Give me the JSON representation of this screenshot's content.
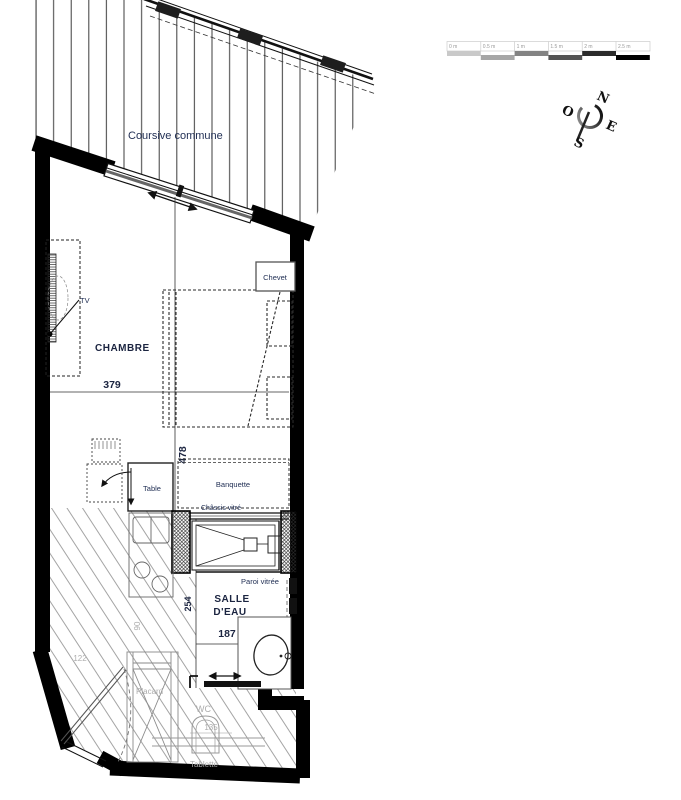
{
  "plan": {
    "walkway_label": "Coursive commune",
    "rooms": {
      "chambre": {
        "name": "CHAMBRE",
        "width_cm": "379",
        "depth_cm": "478"
      },
      "salle_deau": {
        "name_line1": "SALLE",
        "name_line2": "D'EAU",
        "width_cm": "187",
        "depth_cm": "254"
      },
      "wc": {
        "name": "WC",
        "width_cm": "135"
      },
      "entry": {
        "width_cm": "122",
        "door_width_cm": "90"
      }
    },
    "furniture": {
      "chevet": "Chevet",
      "tv": "TV",
      "table": "Table",
      "banquette": "Banquette",
      "placard": "Placard",
      "tablette": "Tablette"
    },
    "glazing": {
      "chassis_vitre": "Châssis vitré",
      "paroi_vitree": "Paroi vitrée"
    }
  },
  "compass": {
    "n": "N",
    "e": "E",
    "s": "S",
    "o": "O"
  },
  "scale_bar": {
    "ticks": [
      "0 m",
      "0.5 m",
      "1 m",
      "1.5 m",
      "2 m",
      "2.5 m"
    ],
    "segment_colors": [
      "#c9c9c9",
      "#a6a6a6",
      "#838383",
      "#545454",
      "#2b2b2b",
      "#000000"
    ]
  },
  "colors": {
    "label_navy": "#223055",
    "label_gray": "#adadad",
    "wall": "#000000"
  }
}
